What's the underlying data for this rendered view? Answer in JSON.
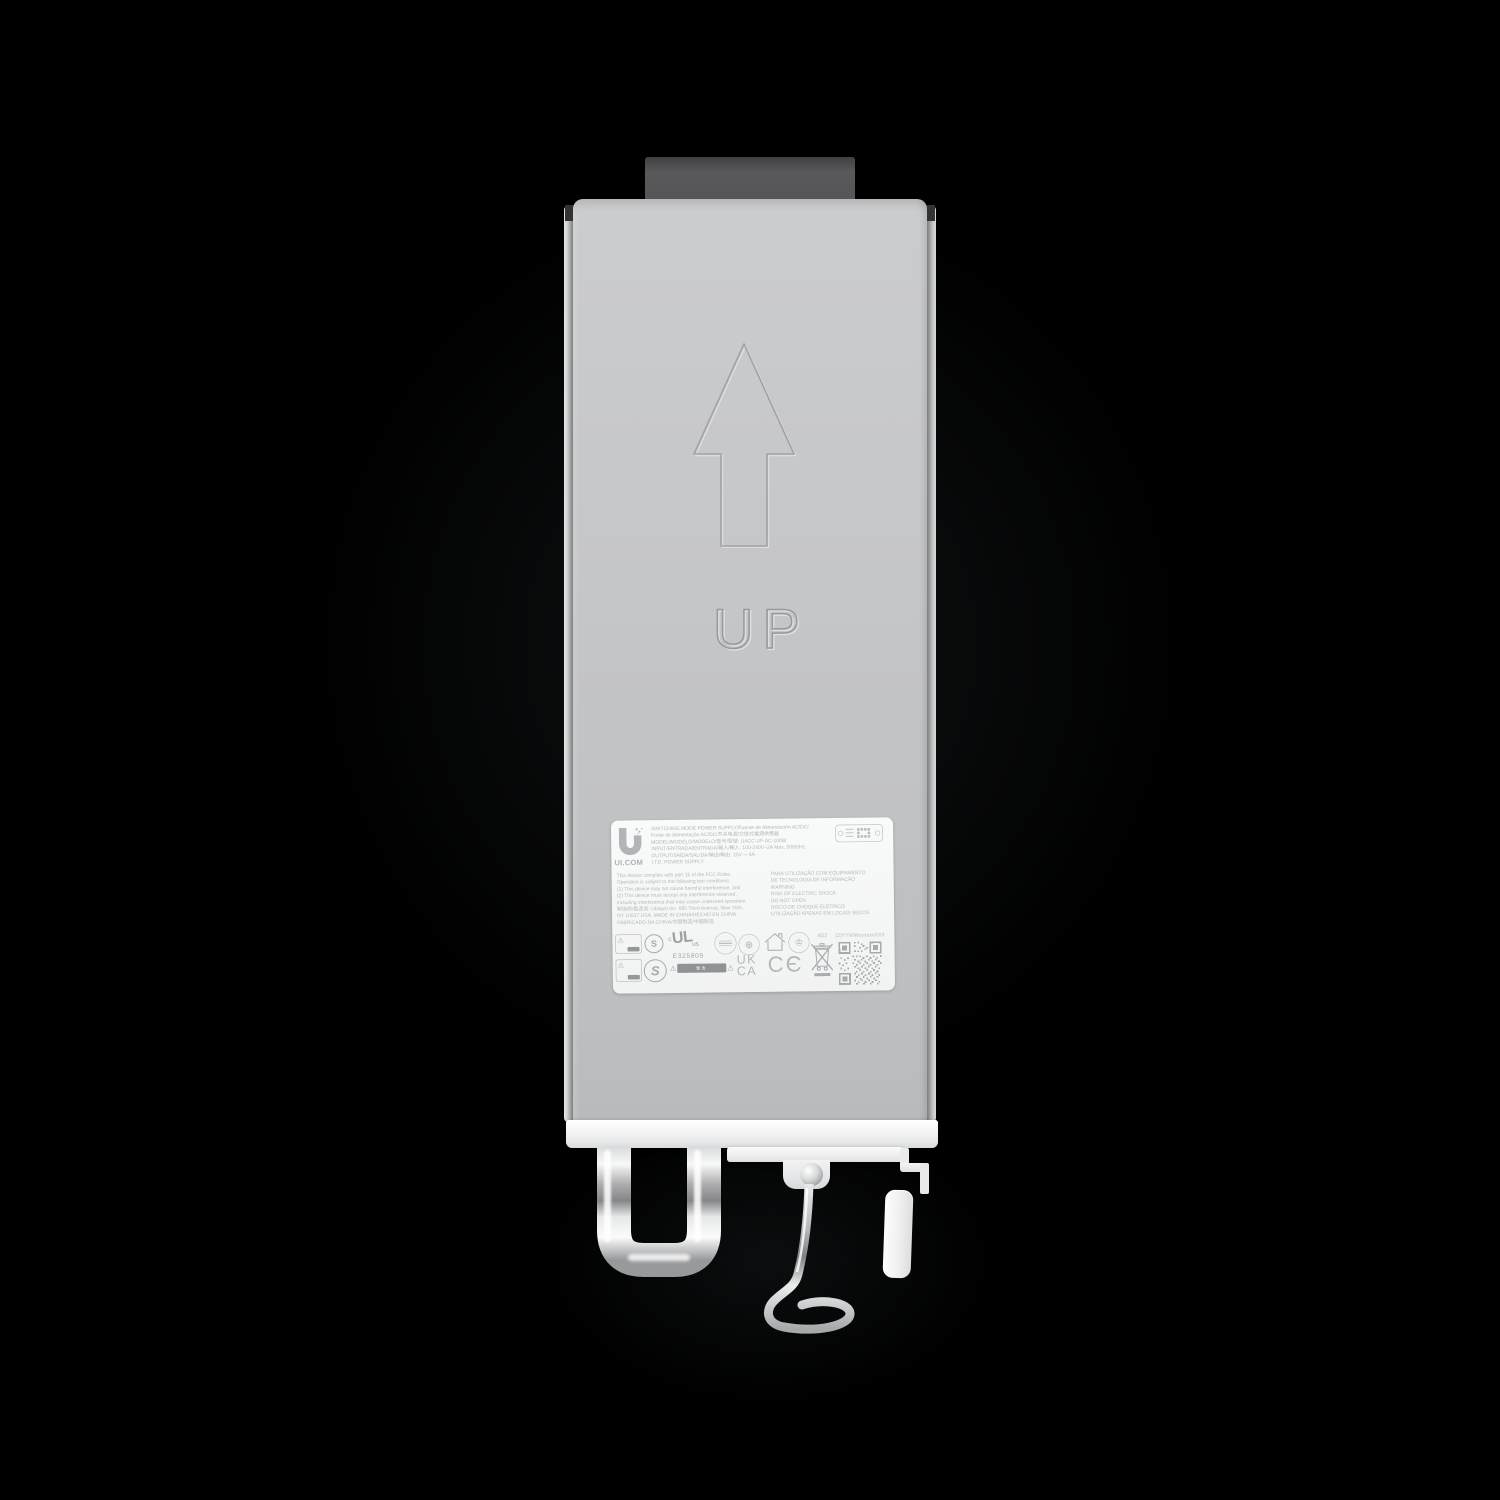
{
  "device": {
    "orientation_marking": "UP",
    "colors": {
      "background": "#000000",
      "body": "#c5c7c9",
      "connector": "#565658",
      "bottom_cap": "#f2f3f3",
      "chrome": "#e8e9ea",
      "label_background": "#f8f9f9",
      "label_text": "#b7babc"
    }
  },
  "label": {
    "brand": "UI.COM",
    "header_lines": [
      "SWITCHING MODE POWER SUPPLY/Fuente de Alimentación AC/DC/",
      "Fonte de Alimentação AC/DC/开关电源/交換式電源供應器",
      "MODEL/MODELO/MODELO/型号/型號: UACC-UF-AC-100W",
      "INPUT/ENTRADA/ENTRADA/输入/輸入: 100-240V~2A Max, 50/60Hz",
      "OUTPUT/SAÍDA/SALIDA/输出/輸出: 25V ⎓ 4A",
      "I.T.E. POWER SUPPLY"
    ],
    "compliance_lines": [
      "This device complies with part 15 of the FCC Rules.",
      "Operation is subject to the following two conditions:",
      "(1) This device may not cause harmful interference, and",
      "(2) This device must accept any interference received,",
      "including interference that may cause undesired operation.",
      "制造商/製造商: Ubiquiti Inc. 685 Third Avenue, New York,",
      "NY 10017 USA.  MADE IN CHINA/HECHO EN CHINA",
      "FABRICADO NA CHINA/中国制造/中國製造"
    ],
    "warning_lines": [
      "PARA UTILIZAÇÃO COM EQUIPAMENTO",
      "DE TECNOLOGIA DE INFORMAÇÃO",
      "WARNING",
      "RISK OF ELECTRIC SHOCK",
      "DO NOT OPEN",
      "RISCO DE CHOQUE ELÉTRICO",
      "UTILIZAÇÃO APENAS EM LOCAIS SECOS"
    ],
    "certifications": {
      "ul_c": "c",
      "ul_mark": "UL",
      "ul_us": "us",
      "ul_file_number": "E325809",
      "s_mark": "S",
      "ukca_top": "UK",
      "ukca_bottom": "CA",
      "ce_mark": "CЄ",
      "warning_strip": "警告",
      "assembly_code": "A52",
      "serial_template": "(2)YYWWxxxxxxXXX"
    }
  }
}
